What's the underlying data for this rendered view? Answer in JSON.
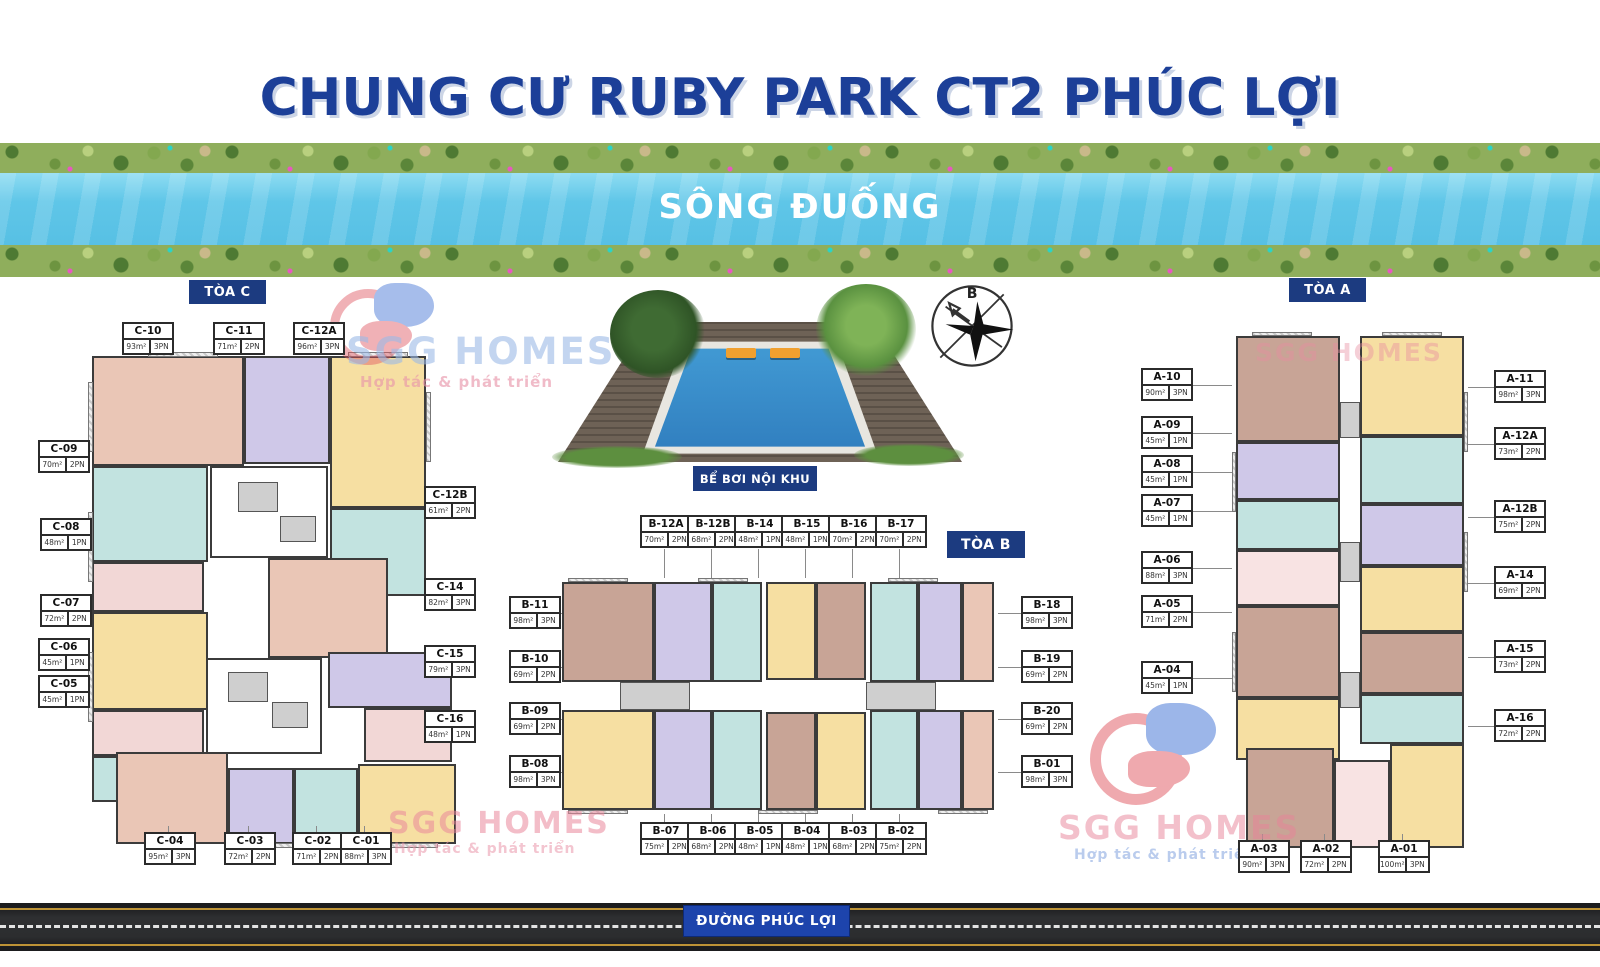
{
  "page_title": "CHUNG CƯ RUBY PARK CT2 PHÚC LỢI",
  "river_label": "SÔNG ĐUỐNG",
  "road_label": "ĐƯỜNG PHÚC LỢI",
  "pool_label": "BỂ BƠI NỘI KHU",
  "compass_label": "B",
  "watermark": {
    "brand": "SGG HOMES",
    "tagline": "Hợp tác & phát triển"
  },
  "towers": {
    "c": {
      "label": "TÒA C",
      "units": [
        {
          "id": "C-10",
          "area": "93m²",
          "rooms": "3PN"
        },
        {
          "id": "C-11",
          "area": "71m²",
          "rooms": "2PN"
        },
        {
          "id": "C-12A",
          "area": "96m²",
          "rooms": "3PN"
        },
        {
          "id": "C-09",
          "area": "70m²",
          "rooms": "2PN"
        },
        {
          "id": "C-08",
          "area": "48m²",
          "rooms": "1PN"
        },
        {
          "id": "C-07",
          "area": "72m²",
          "rooms": "2PN"
        },
        {
          "id": "C-06",
          "area": "45m²",
          "rooms": "1PN"
        },
        {
          "id": "C-05",
          "area": "45m²",
          "rooms": "1PN"
        },
        {
          "id": "C-04",
          "area": "95m²",
          "rooms": "3PN"
        },
        {
          "id": "C-03",
          "area": "72m²",
          "rooms": "2PN"
        },
        {
          "id": "C-02",
          "area": "71m²",
          "rooms": "2PN"
        },
        {
          "id": "C-01",
          "area": "88m²",
          "rooms": "3PN"
        },
        {
          "id": "C-12B",
          "area": "61m²",
          "rooms": "2PN"
        },
        {
          "id": "C-14",
          "area": "82m²",
          "rooms": "3PN"
        },
        {
          "id": "C-15",
          "area": "79m²",
          "rooms": "3PN"
        },
        {
          "id": "C-16",
          "area": "48m²",
          "rooms": "1PN"
        }
      ]
    },
    "b": {
      "label": "TÒA B",
      "units": [
        {
          "id": "B-12A",
          "area": "70m²",
          "rooms": "2PN"
        },
        {
          "id": "B-12B",
          "area": "68m²",
          "rooms": "2PN"
        },
        {
          "id": "B-14",
          "area": "48m²",
          "rooms": "1PN"
        },
        {
          "id": "B-15",
          "area": "48m²",
          "rooms": "1PN"
        },
        {
          "id": "B-16",
          "area": "70m²",
          "rooms": "2PN"
        },
        {
          "id": "B-17",
          "area": "70m²",
          "rooms": "2PN"
        },
        {
          "id": "B-11",
          "area": "98m²",
          "rooms": "3PN"
        },
        {
          "id": "B-10",
          "area": "69m²",
          "rooms": "2PN"
        },
        {
          "id": "B-09",
          "area": "69m²",
          "rooms": "2PN"
        },
        {
          "id": "B-08",
          "area": "98m²",
          "rooms": "3PN"
        },
        {
          "id": "B-18",
          "area": "98m²",
          "rooms": "3PN"
        },
        {
          "id": "B-19",
          "area": "69m²",
          "rooms": "2PN"
        },
        {
          "id": "B-20",
          "area": "69m²",
          "rooms": "2PN"
        },
        {
          "id": "B-01",
          "area": "98m²",
          "rooms": "3PN"
        },
        {
          "id": "B-07",
          "area": "75m²",
          "rooms": "2PN"
        },
        {
          "id": "B-06",
          "area": "68m²",
          "rooms": "2PN"
        },
        {
          "id": "B-05",
          "area": "48m²",
          "rooms": "1PN"
        },
        {
          "id": "B-04",
          "area": "48m²",
          "rooms": "1PN"
        },
        {
          "id": "B-03",
          "area": "68m²",
          "rooms": "2PN"
        },
        {
          "id": "B-02",
          "area": "75m²",
          "rooms": "2PN"
        }
      ]
    },
    "a": {
      "label": "TÒA A",
      "units": [
        {
          "id": "A-10",
          "area": "90m²",
          "rooms": "3PN"
        },
        {
          "id": "A-09",
          "area": "45m²",
          "rooms": "1PN"
        },
        {
          "id": "A-08",
          "area": "45m²",
          "rooms": "1PN"
        },
        {
          "id": "A-07",
          "area": "45m²",
          "rooms": "1PN"
        },
        {
          "id": "A-06",
          "area": "88m²",
          "rooms": "3PN"
        },
        {
          "id": "A-05",
          "area": "71m²",
          "rooms": "2PN"
        },
        {
          "id": "A-04",
          "area": "45m²",
          "rooms": "1PN"
        },
        {
          "id": "A-11",
          "area": "98m²",
          "rooms": "3PN"
        },
        {
          "id": "A-12A",
          "area": "73m²",
          "rooms": "2PN"
        },
        {
          "id": "A-12B",
          "area": "75m²",
          "rooms": "2PN"
        },
        {
          "id": "A-14",
          "area": "69m²",
          "rooms": "2PN"
        },
        {
          "id": "A-15",
          "area": "73m²",
          "rooms": "2PN"
        },
        {
          "id": "A-16",
          "area": "72m²",
          "rooms": "2PN"
        },
        {
          "id": "A-03",
          "area": "90m²",
          "rooms": "3PN"
        },
        {
          "id": "A-02",
          "area": "72m²",
          "rooms": "2PN"
        },
        {
          "id": "A-01",
          "area": "100m²",
          "rooms": "3PN"
        }
      ]
    }
  }
}
